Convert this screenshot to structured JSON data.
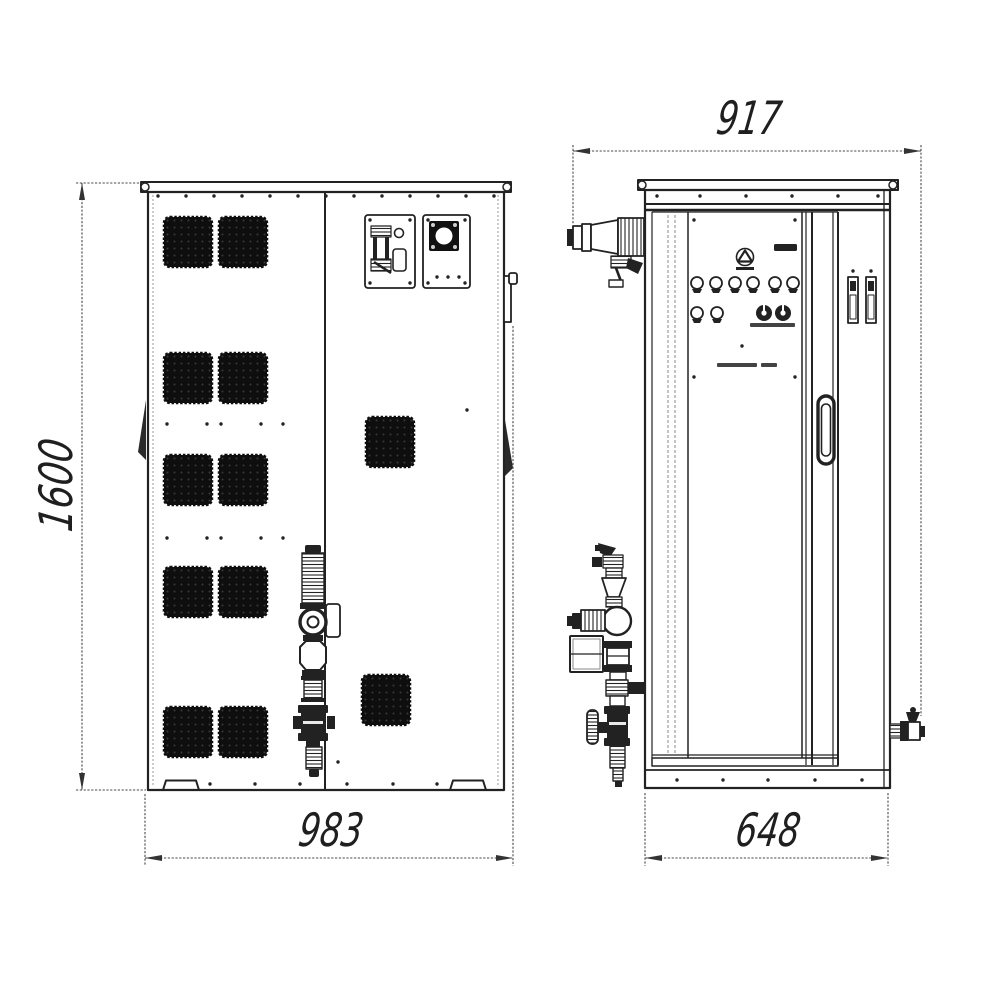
{
  "drawing": {
    "subject": "Industrial cabinet technical drawing, front and side orthographic views",
    "views": [
      {
        "name": "front view"
      },
      {
        "name": "side view"
      }
    ],
    "dimensions": {
      "overall_height": "1600",
      "front_overall_width": "983",
      "side_overall_depth": "917",
      "side_cabinet_width": "648"
    },
    "colors": {
      "line": "#222222",
      "dim_line": "#4a4a4a",
      "grille_fill": "#0e0e0e",
      "background": "#ffffff"
    }
  }
}
